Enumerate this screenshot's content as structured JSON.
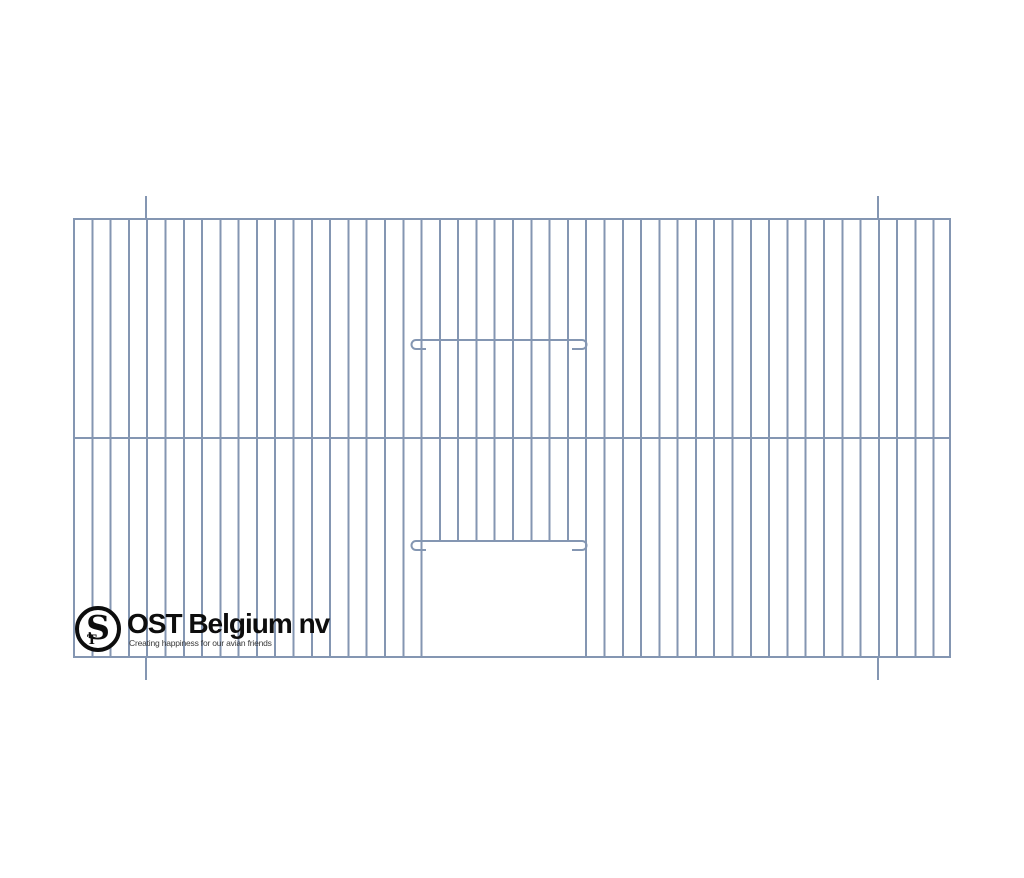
{
  "colors": {
    "wire": "#8496b2",
    "ink": "#0d0d0d",
    "tagline_ink": "#3a3a3a"
  },
  "brand": {
    "monogram_s": "S",
    "monogram_t": "T",
    "company_name": "OST Belgium nv",
    "tagline": "Creating happiness for our avian friends"
  }
}
